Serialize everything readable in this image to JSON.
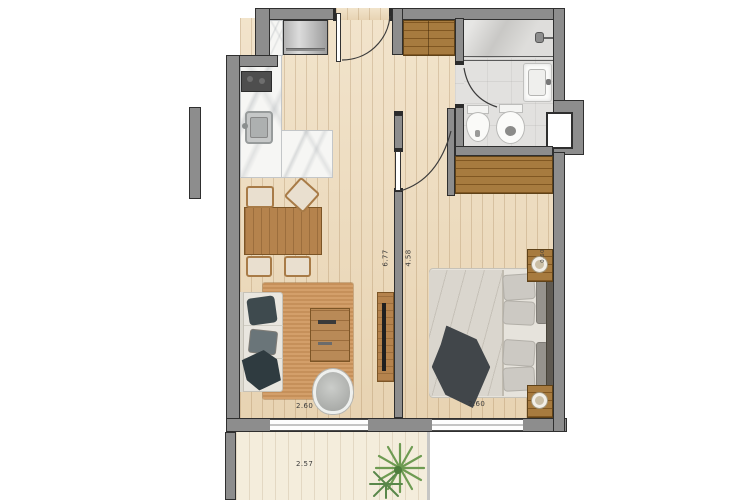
{
  "plan": {
    "type": "apartment-floor-plan",
    "dimension_labels": {
      "living_width": "2.60",
      "bedroom_width": "2.60",
      "terrace_width": "2.57",
      "living_length": "6.77",
      "bedroom_length": "4.58",
      "nightstand_width": "0.60"
    },
    "colors": {
      "wall": "#8d8d8d",
      "wall_outline": "#2f2f2f",
      "wood_floor": "#eedcbd",
      "terrace_floor": "#f4eddc",
      "bathroom_floor": "#e2e1df",
      "furniture_wood": "#b5834d",
      "rug": "#d0985f",
      "plant_green": "#6e9b52"
    }
  }
}
